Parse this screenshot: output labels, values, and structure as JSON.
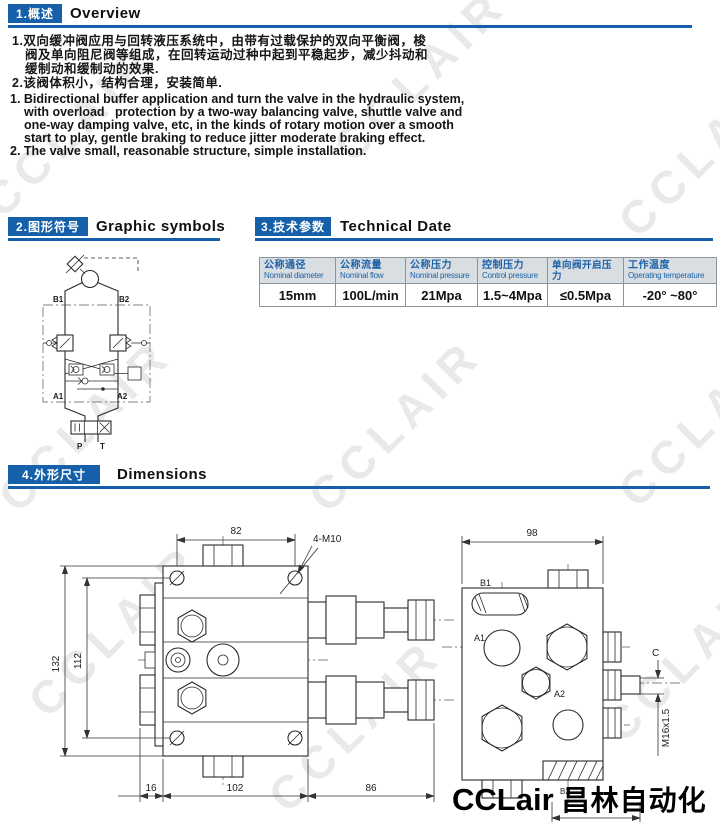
{
  "page": {
    "watermark": "CCLAIR",
    "logo_latin": "CCLair",
    "logo_cjk": "昌林自动化"
  },
  "overview": {
    "chip": "1.概述",
    "title": "Overview",
    "cn": [
      "1.双向缓冲阀应用与回转液压系统中，由带有过载保护的双向平衡阀，梭",
      "阀及单向阻尼阀等组成，在回转运动过种中起到平稳起步，减少抖动和",
      "缓制动和缓制动的效果.",
      "2.该阀体积小，结构合理，安装简单."
    ],
    "en": [
      "1. Bidirectional buffer application and turn the valve in the hydraulic system,",
      "with overload   protection by a two-way balancing valve, shuttle valve and",
      "one-way damping valve, etc, in the kinds of rotary motion over a smooth",
      "start to play, gentle braking to reduce jitter moderate braking effect.",
      "2. The valve small, reasonable structure, simple installation."
    ]
  },
  "symbols": {
    "chip": "2.图形符号",
    "title": "Graphic symbols",
    "b1": "B1",
    "b2": "B2",
    "a1": "A1",
    "a2": "A2",
    "p": "P",
    "t": "T"
  },
  "technical": {
    "chip": "3.技术参数",
    "title": "Technical Date",
    "headers": [
      {
        "cn": "公称通径",
        "en": "Nominal diameter"
      },
      {
        "cn": "公称流量",
        "en": "Nominal flow"
      },
      {
        "cn": "公称压力",
        "en": "Nominal pressure"
      },
      {
        "cn": "控制压力",
        "en": "Control pressure"
      },
      {
        "cn": "单向阀开启压力",
        "en": ""
      },
      {
        "cn": "工作温度",
        "en": "Operating temperature"
      }
    ],
    "values": [
      "15mm",
      "100L/min",
      "21Mpa",
      "1.5~4Mpa",
      "≤0.5Mpa",
      "-20° ~80°"
    ]
  },
  "dimensions": {
    "chip": "4.外形尺寸",
    "title": "Dimensions",
    "front": {
      "w": "82",
      "h_outer": "132",
      "h_inner": "112",
      "b_left": "16",
      "b_mid": "102",
      "b_right": "86",
      "bolts": "4-M10"
    },
    "side": {
      "w": "98",
      "b1": "B1",
      "a1": "A1",
      "a2": "A2",
      "b2": "B2",
      "c": "C",
      "thread": "M16x1.5"
    }
  }
}
